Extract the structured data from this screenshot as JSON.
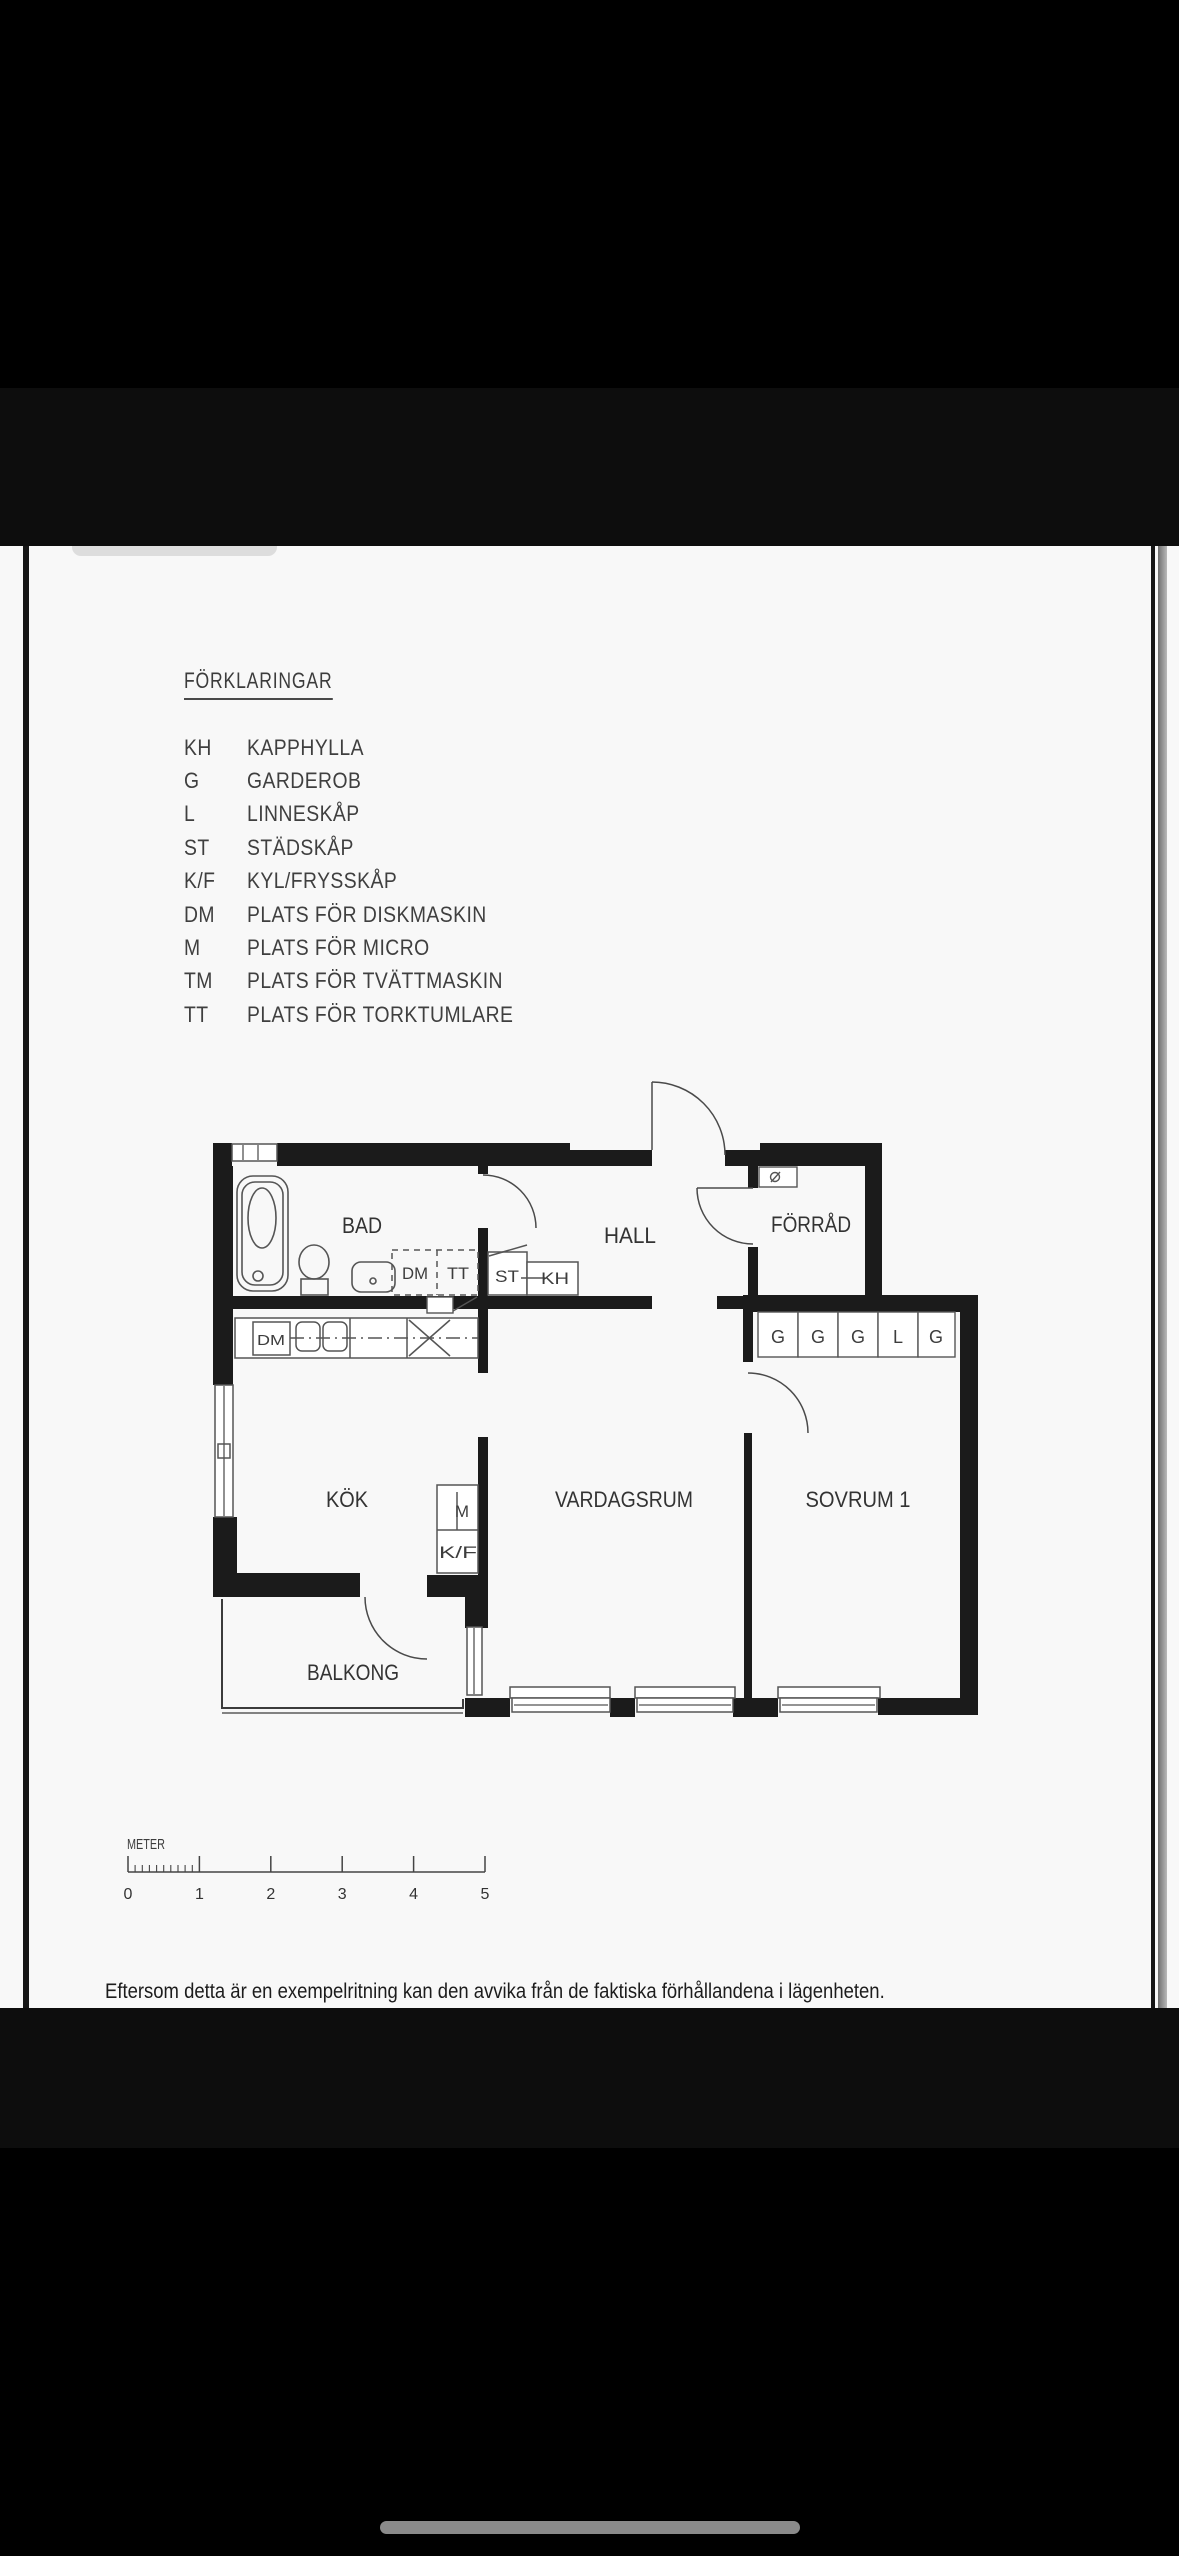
{
  "legend": {
    "title": "FÖRKLARINGAR",
    "rows": [
      {
        "abbr": "KH",
        "label": "KAPPHYLLA"
      },
      {
        "abbr": "G",
        "label": "GARDEROB"
      },
      {
        "abbr": "L",
        "label": "LINNESKÅP"
      },
      {
        "abbr": "ST",
        "label": "STÄDSKÅP"
      },
      {
        "abbr": "K/F",
        "label": "KYL/FRYSSKÅP"
      },
      {
        "abbr": "DM",
        "label": "PLATS FÖR DISKMASKIN"
      },
      {
        "abbr": "M",
        "label": "PLATS FÖR MICRO"
      },
      {
        "abbr": "TM",
        "label": "PLATS FÖR TVÄTTMASKIN"
      },
      {
        "abbr": "TT",
        "label": "PLATS FÖR TORKTUMLARE"
      }
    ]
  },
  "floorplan": {
    "rooms": {
      "bad": "BAD",
      "hall": "HALL",
      "forrad": "FÖRRÅD",
      "kok": "KÖK",
      "vardagsrum": "VARDAGSRUM",
      "sovrum": "SOVRUM 1",
      "balkong": "BALKONG"
    },
    "labels": {
      "dm": "DM",
      "tt": "TT",
      "st": "ST",
      "kh": "KH",
      "counter_dm": "DM",
      "micro": "M",
      "kyl_frys": "K/F"
    },
    "closets": [
      "G",
      "G",
      "G",
      "L",
      "G"
    ]
  },
  "scale_bar": {
    "unit": "METER",
    "ticks": [
      "0",
      "1",
      "2",
      "3",
      "4",
      "5"
    ]
  },
  "footer": {
    "disclaimer": "Eftersom detta är en exempelritning kan den avvika från de faktiska förhållandena i lägenheten."
  },
  "colors": {
    "page_bg": "#f8f8f8",
    "wall": "#1b1b1b",
    "thin_line": "#555555",
    "text": "#3a3a3a",
    "scrollbar": "#9a9a9a",
    "home_indicator": "#8a8a8a",
    "bezel": "#000000",
    "band": "#0d0d0d"
  }
}
